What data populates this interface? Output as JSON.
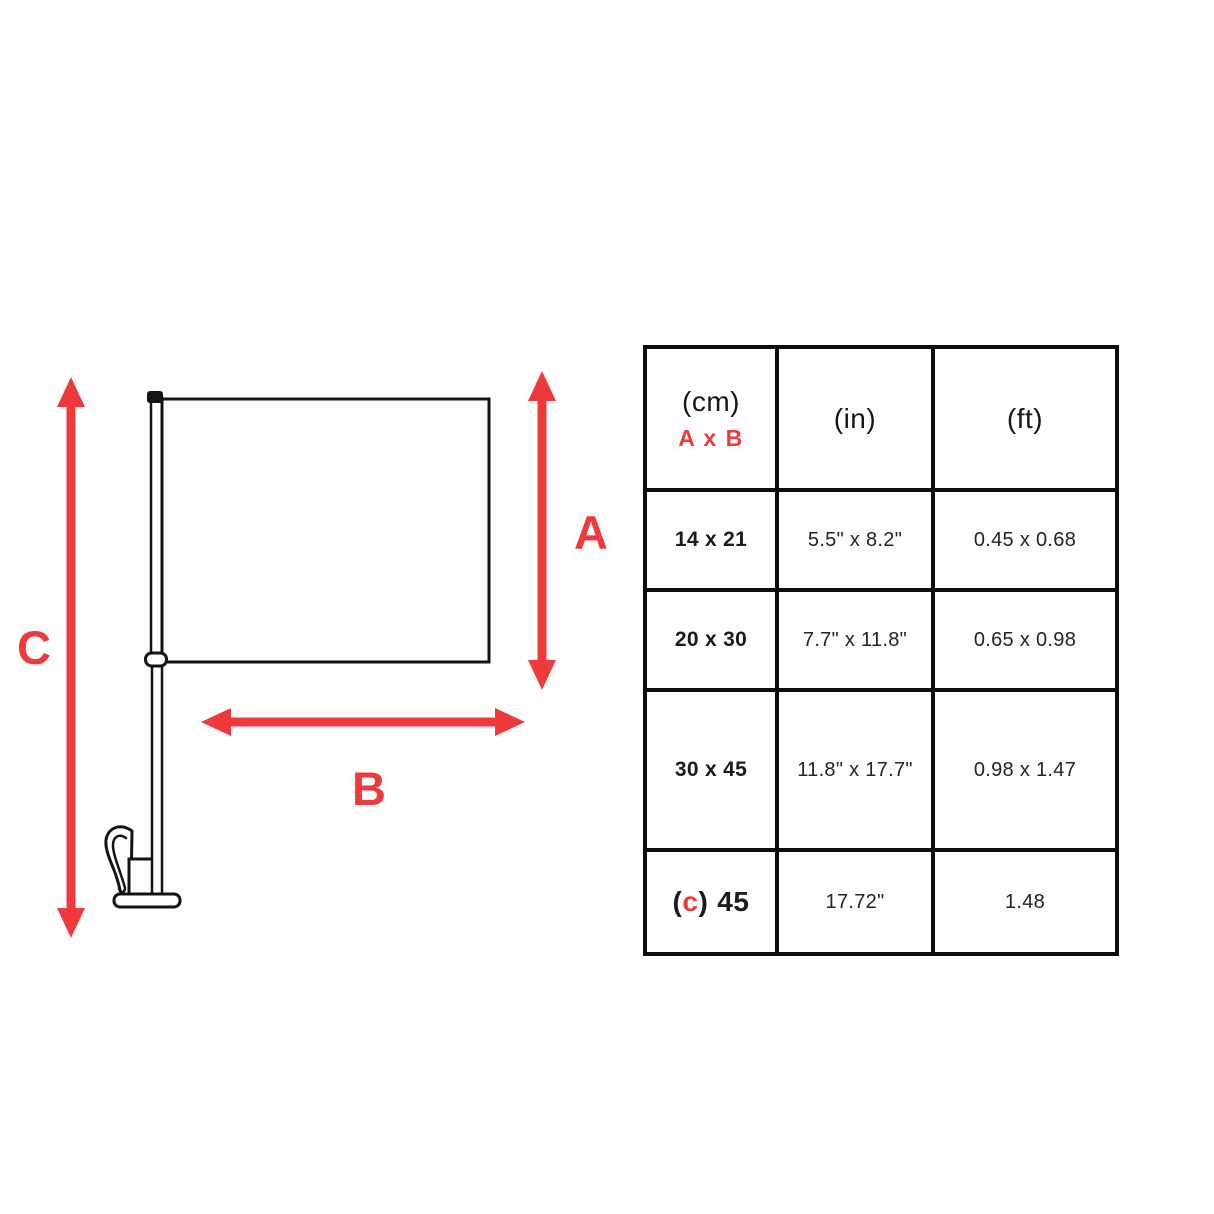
{
  "diagram": {
    "label_a": "A",
    "label_b": "B",
    "label_c": "C",
    "arrow_color": "#ee3a3c",
    "outline_color": "#141414"
  },
  "size_table": {
    "header": {
      "cm_unit": "(cm)",
      "cm_axis": "A x B",
      "in_unit": "(in)",
      "ft_unit": "(ft)"
    },
    "rows": [
      {
        "cm": "14 x 21",
        "inches": "5.5\" x 8.2\"",
        "feet": "0.45 x 0.68"
      },
      {
        "cm": "20 x 30",
        "inches": "7.7\" x 11.8\"",
        "feet": "0.65 x 0.98"
      },
      {
        "cm": "30 x 45",
        "inches": "11.8\" x 17.7\"",
        "feet": "0.98 x 1.47"
      }
    ],
    "c_row": {
      "paren_open": "(",
      "c_label": "c",
      "paren_close": ")",
      "value": "45",
      "inches": "17.72\"",
      "feet": "1.48"
    }
  }
}
